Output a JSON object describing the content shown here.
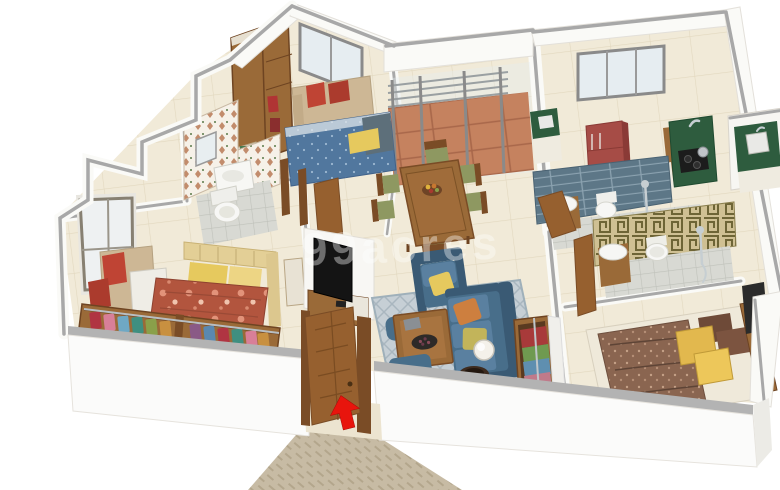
{
  "scene": {
    "type": "3d-isometric-floor-plan",
    "description": "3D rendered isometric floor plan of a furnished apartment viewed from above-front, white walls with grey tops, entry door ajar with red entry arrow and textured walkway",
    "watermark": "99acres",
    "entry_indicator": "red-arrow-at-main-door"
  },
  "rooms": [
    {
      "name": "bedroom-2",
      "furniture": [
        "wardrobe-with-clothes",
        "window-seat-sofa-red-pillows",
        "double-bed-blue-blanket-yellow-pillow",
        "window"
      ]
    },
    {
      "name": "bathroom-1",
      "furniture": [
        "mosaic-pattern-walls",
        "mirror",
        "washbasin",
        "toilet",
        "wooden-door"
      ]
    },
    {
      "name": "balcony",
      "furniture": [
        "railing",
        "sliding-glass-doors",
        "terracotta-tile-floor"
      ]
    },
    {
      "name": "dining-area",
      "furniture": [
        "six-seater-wooden-dining-table",
        "fruit-bowl",
        "six-chairs-olive-seats"
      ]
    },
    {
      "name": "kitchen",
      "furniture": [
        "window",
        "red-refrigerator",
        "green-counter-with-sink",
        "l-counter-gas-stove-kettle",
        "cabinets"
      ]
    },
    {
      "name": "utility-area",
      "furniture": [
        "green-counter",
        "wash-sink"
      ]
    },
    {
      "name": "common-bathroom",
      "furniture": [
        "grey-tiled-walls",
        "washbasin-on-cabinet",
        "toilet",
        "shower",
        "wooden-door"
      ]
    },
    {
      "name": "bathroom-2",
      "furniture": [
        "greek-key-pattern-walls",
        "washbasin-on-cabinet",
        "wall-hung-toilet",
        "shower",
        "wooden-door"
      ]
    },
    {
      "name": "living-room",
      "furniture": [
        "tv-unit",
        "flat-tv",
        "patterned-rug",
        "three-seater-sofa-blue",
        "armchair-blue",
        "two-ottomans",
        "wooden-coffee-table",
        "snack-plate",
        "globe-floor-lamp",
        "round-side-table"
      ]
    },
    {
      "name": "master-bedroom",
      "furniture": [
        "tall-window",
        "window-seat-red-pillows",
        "bench-chest",
        "double-bed-floral-red-blanket",
        "yellow-pillows",
        "upholstered-headboard",
        "open-closet-row-colorful-clothes",
        "dresser"
      ]
    },
    {
      "name": "bedroom-3",
      "furniture": [
        "double-bed-brown-blanket",
        "yellow-pillows",
        "wooden-headboard",
        "open-wardrobe-colorful-clothes",
        "dark-wall-panel"
      ]
    },
    {
      "name": "entrance",
      "furniture": [
        "wooden-main-door-ajar",
        "door-frame",
        "entry-arrow",
        "textured-walkway"
      ]
    }
  ],
  "colors": {
    "wallWhite": "#fafaf7",
    "coping": "#a8a8a8",
    "floorCream": "#f1ead8",
    "wood": "#9a6a38",
    "woodDark": "#7a4c26",
    "doorWood": "#96602f",
    "sofaBlue": "#486e8a",
    "sofaLight": "#5a80a0",
    "sofaDark": "#3a5a74",
    "pillowYellow": "#e6c95e",
    "redPillow": "#bf4434",
    "bedBlue": "#51779e",
    "blanketBrown": "#8a6550",
    "floralRed": "#b2553e",
    "counterGreen": "#2e5c3e",
    "fridgeRed": "#a64c46",
    "tileGrey": "#5d7787",
    "greekTan": "#cfc093",
    "terracotta": "#c5825f",
    "walkway": "#c7bba4",
    "rugGrey": "#c6cfd5",
    "arrowRed": "#e8150d",
    "beige": "#cdb795",
    "glass": "#e6edf1",
    "frame": "#8a8a8a"
  }
}
